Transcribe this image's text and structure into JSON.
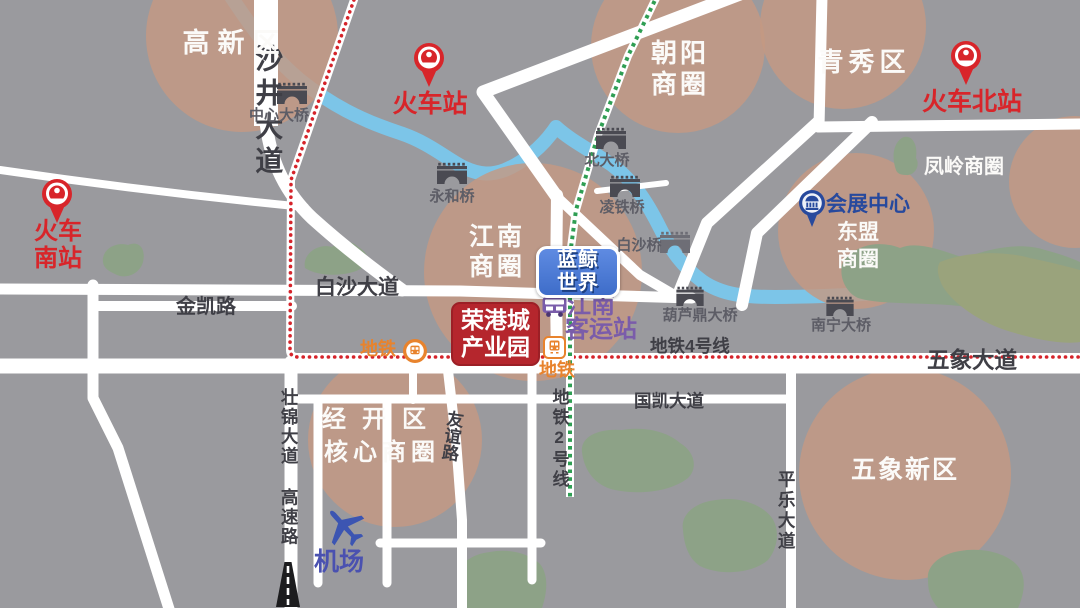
{
  "colors": {
    "background": "#9a9a9e",
    "road": "#ffffff",
    "river": "#7cc5e8",
    "district_zone": "#c59a87",
    "green_space": "#8da287",
    "metro_line4": "#d5232a",
    "metro_line2": "#2f9e53",
    "railway_station": "#d8252a",
    "metro_entrance": "#e8832d",
    "bus_station": "#7a5caa",
    "convention": "#27499d",
    "badge_blue": "#4d7dd6",
    "badge_red": "#b5262d"
  },
  "districts": {
    "gaoxinqu": "高新区",
    "chaoyang": {
      "l1": "朝阳",
      "l2": "商圈"
    },
    "qingxiuqu": "青秀区",
    "fengling_shangquan": "凤岭商圈",
    "dongmeng_shangquan": {
      "l1": "东盟",
      "l2": "商圈"
    },
    "jiangnan_shangquan": {
      "l1": "江南",
      "l2": "商圈"
    },
    "jingkaiqu_hexin_shangquan": {
      "l1": "经开区",
      "l2": "核心商圈"
    },
    "wuxiang_xinqu": "五象新区"
  },
  "stations": {
    "huochezhan": "火车站",
    "huoche_beizhan": "火车北站",
    "huoche_nanzhan": {
      "l1": "火车",
      "l2": "南站"
    },
    "huizhan_zhongxin": "会展中心",
    "jiangnan_keyunzhan": {
      "l1": "江南",
      "l2": "客运站"
    },
    "ditie": "地铁",
    "jichang": "机场"
  },
  "roads": {
    "shajing_dadao": "沙井大道",
    "baisha_dadao": "白沙大道",
    "jinkai_lu": "金凯路",
    "wuxiang_dadao": "五象大道",
    "guokai_dadao": "国凯大道",
    "youyi_lu": "友谊路",
    "zhuangjin_dadao_gaosulu": "壮锦大道 高速路",
    "pingle_dadao": "平乐大道"
  },
  "metro": {
    "line4_label": "地铁4号线",
    "line2_label": "地铁2号线"
  },
  "bridges": {
    "zhongxin_daqiao": "中心大桥",
    "yonghe_qiao": "永和桥",
    "beida_qiao": "北大桥",
    "lingtie_qiao": "凌铁桥",
    "baisha_qiao": "白沙桥",
    "huluding_daqiao": "葫芦鼎大桥",
    "nanning_daqiao": "南宁大桥"
  },
  "landmarks": {
    "lanjing_shijie": {
      "l1": "蓝鲸",
      "l2": "世界"
    },
    "ronggangcheng_chanyeyuan": {
      "l1": "荣港城",
      "l2": "产业园"
    }
  }
}
